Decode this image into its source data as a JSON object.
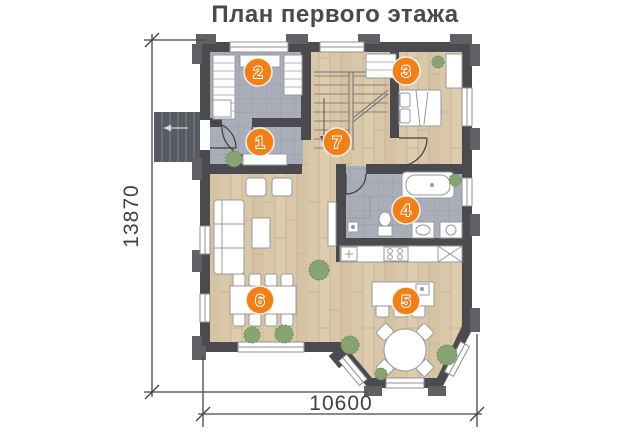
{
  "title": "План первого этажа",
  "dimensions": {
    "vertical": "13870",
    "horizontal": "10600"
  },
  "rooms": [
    {
      "number": "1"
    },
    {
      "number": "2"
    },
    {
      "number": "3"
    },
    {
      "number": "4"
    },
    {
      "number": "5"
    },
    {
      "number": "6"
    },
    {
      "number": "7"
    }
  ],
  "colors": {
    "accent_orange": "#F28019",
    "wall": "#4B4B4F",
    "tile_floor": "#A9AEB9",
    "wood_floor": "#D9C7A9",
    "background": "#FFFFFF",
    "text": "#4A4A4D"
  }
}
